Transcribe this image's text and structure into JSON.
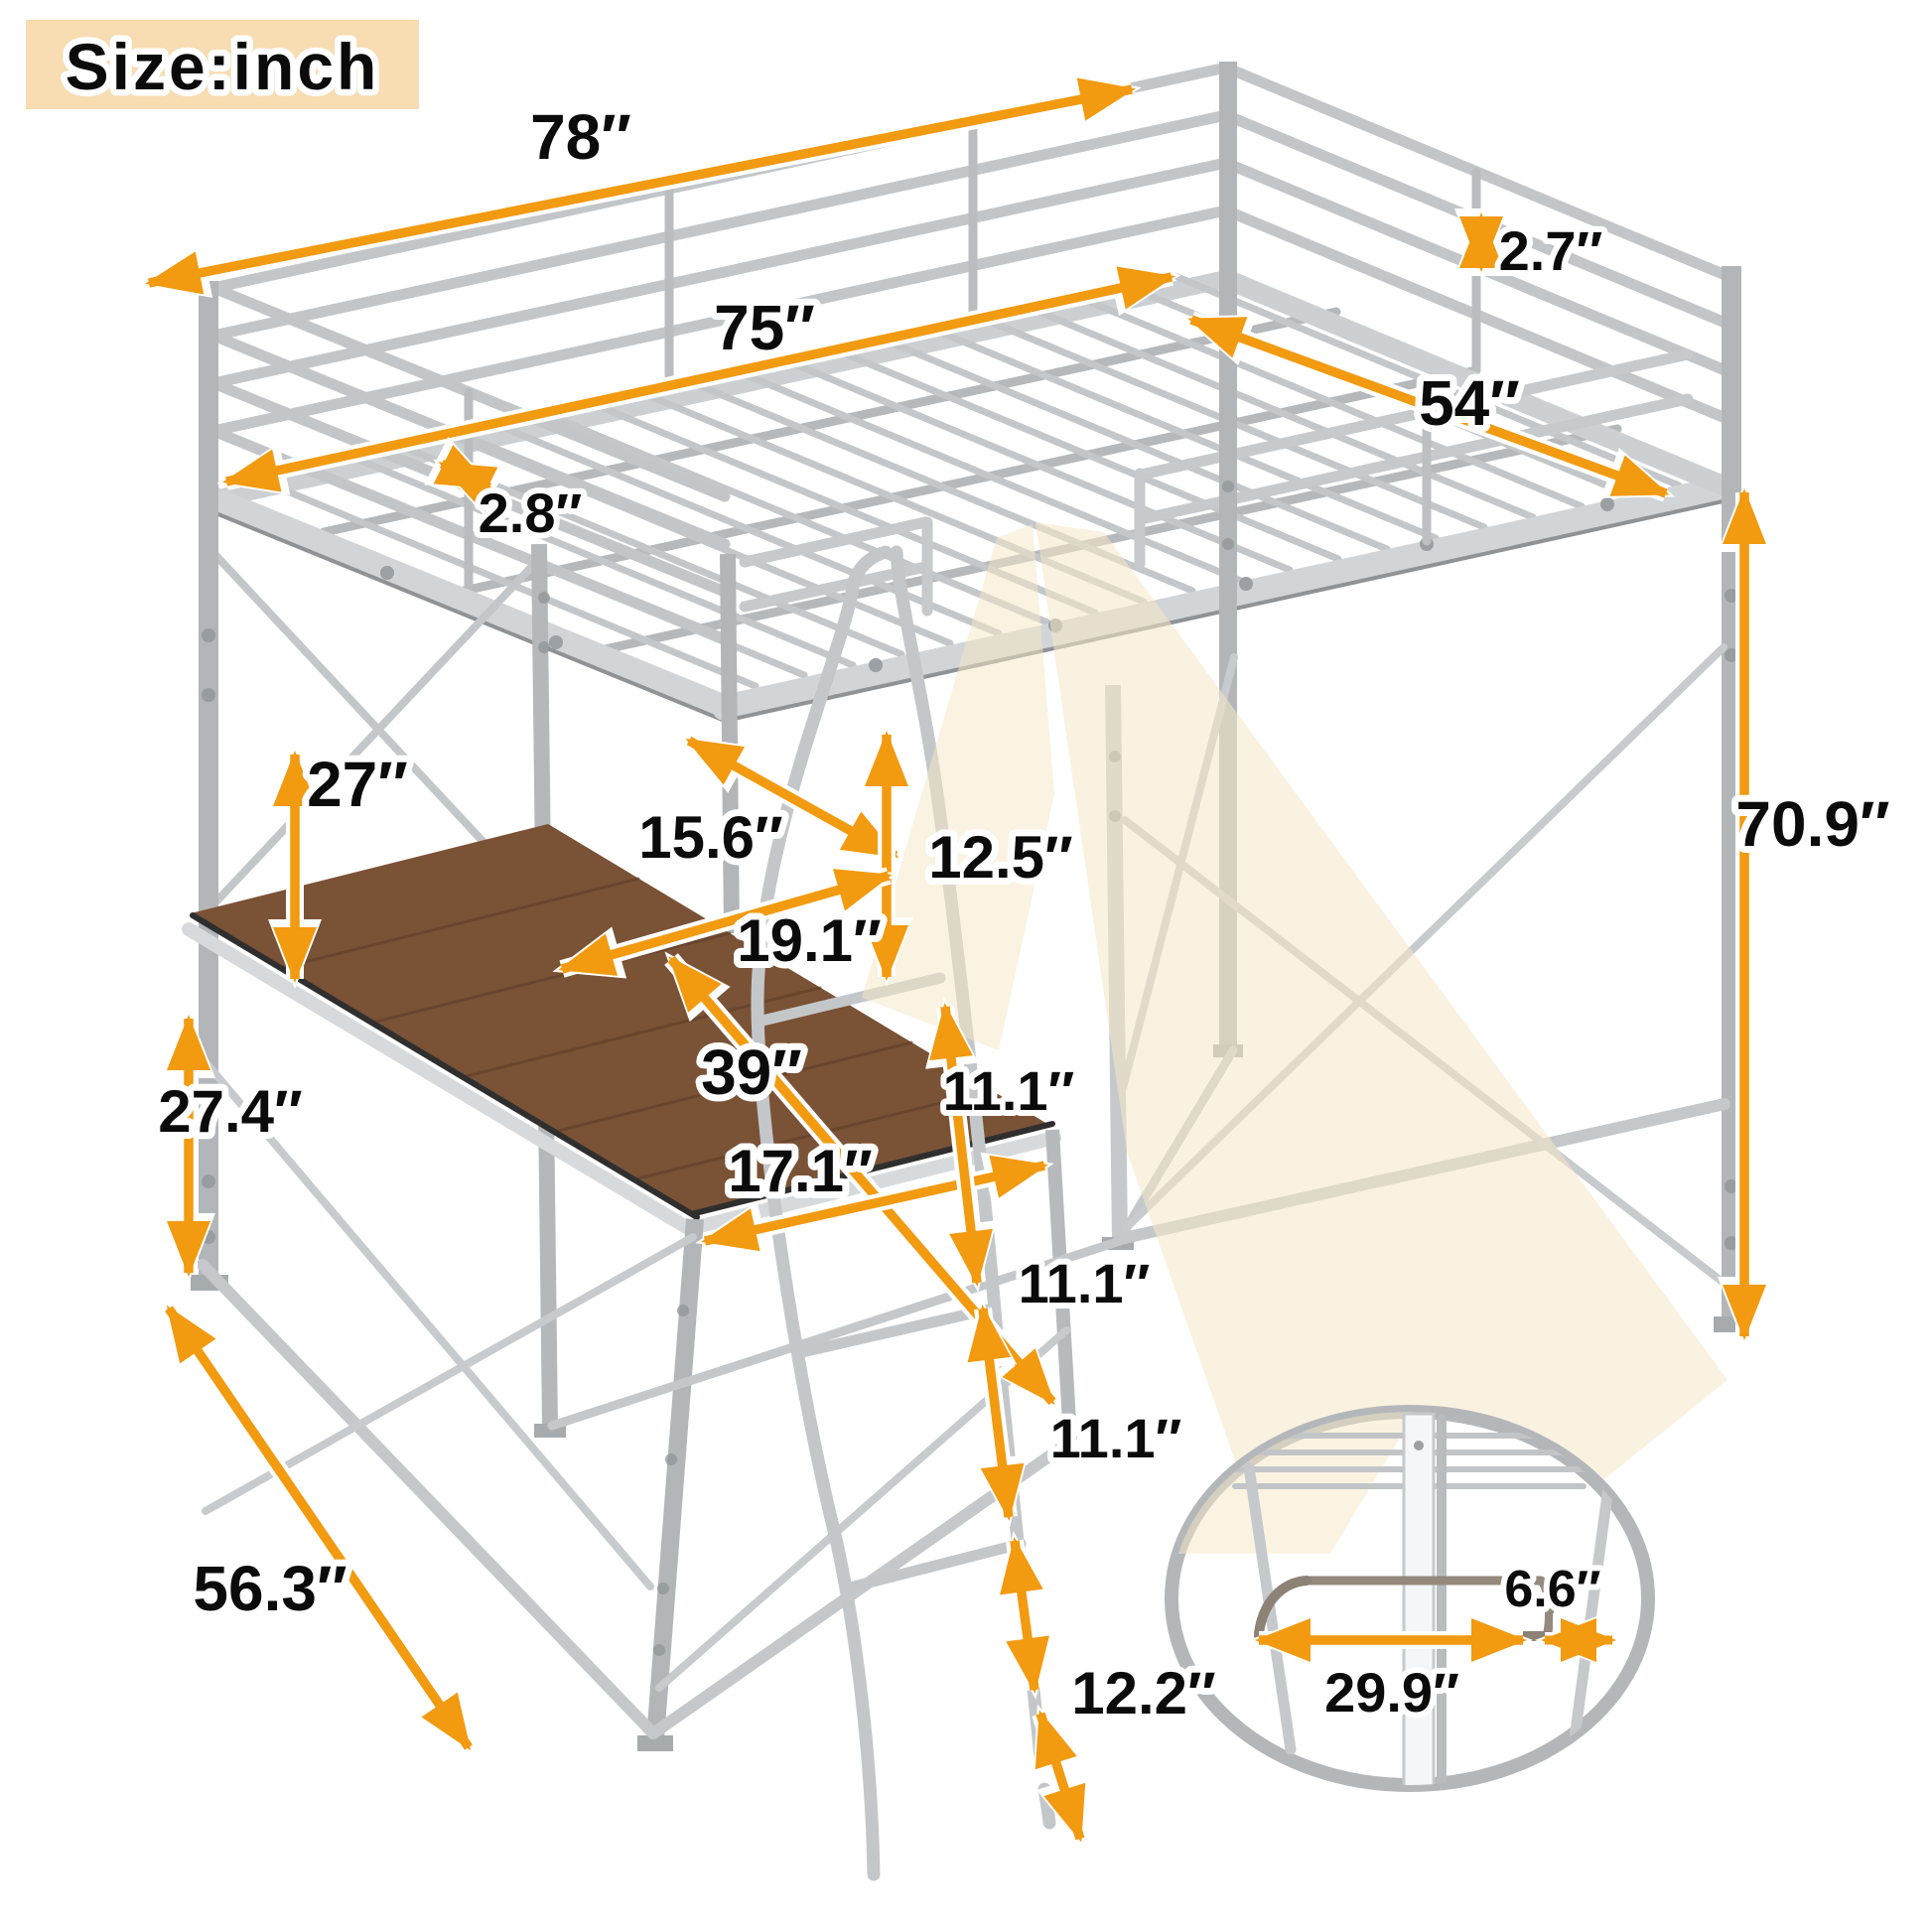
{
  "title": "Size:inch",
  "unit": "inch",
  "colors": {
    "accent_arrow": "#f29a10",
    "title_background": "#f8dcb2",
    "metal_frame": "#bfc3c6",
    "desk_wood": "#7a5236",
    "light_beam": "#f5e7c6"
  },
  "labels": {
    "bed_length_top": "78″",
    "bed_length_inner": "75″",
    "guardrail_gap": "2.7″",
    "bed_width": "54″",
    "rail_spacing": "2.8″",
    "bed_to_desk_clearance": "27″",
    "desk_back_depth": "15.6″",
    "deck_to_first_rung": "12.5″",
    "desk_side_width": "19.1″",
    "desk_diagonal": "39″",
    "desk_front_edge": "17.1″",
    "rung_spacing_1": "11.1″",
    "rung_spacing_2": "11.1″",
    "rung_spacing_3": "11.1″",
    "desk_height": "27.4″",
    "base_depth": "56.3″",
    "ladder_bottom_clearance": "12.2″",
    "overall_height": "70.9″",
    "rod_length": "29.9″",
    "rod_offset": "6.6″"
  }
}
